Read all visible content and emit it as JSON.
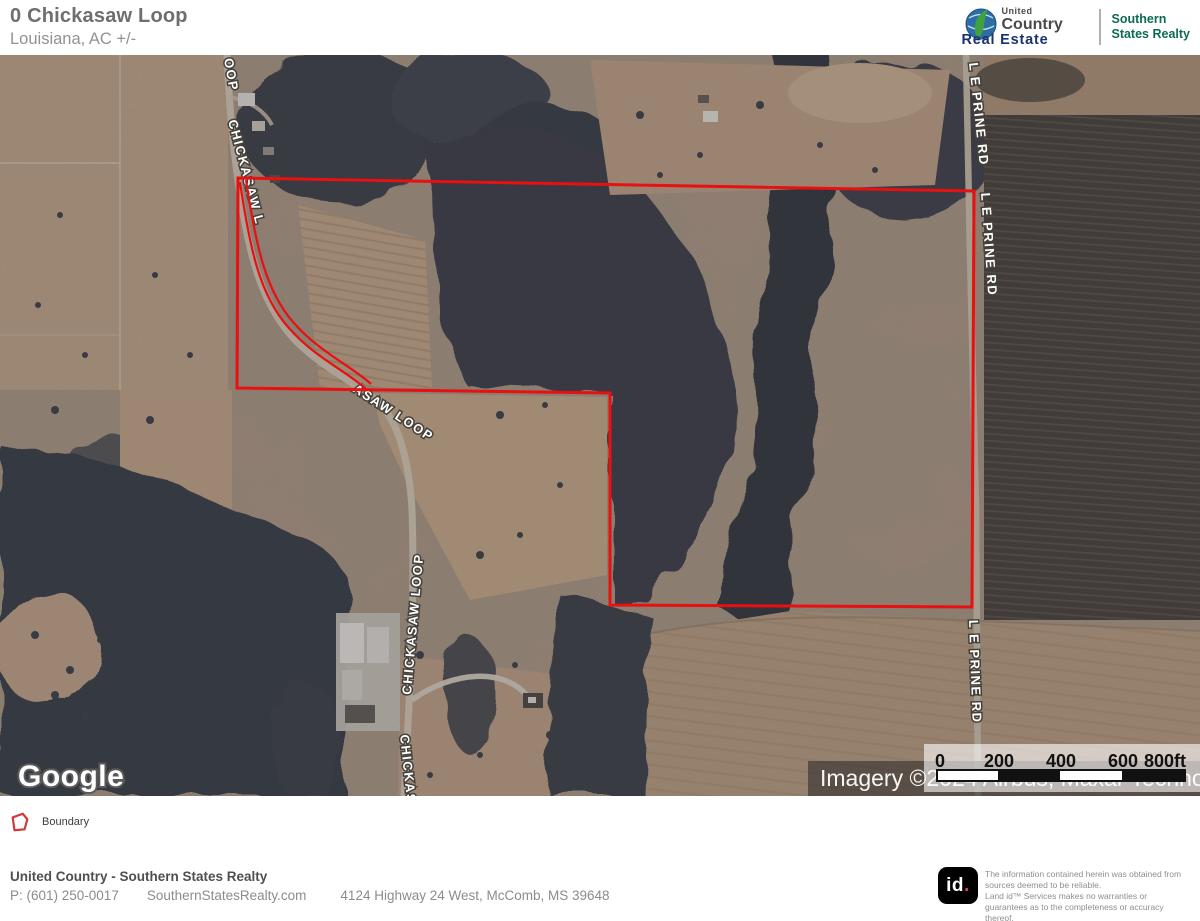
{
  "header": {
    "title": "0 Chickasaw Loop",
    "subtitle": "Louisiana,  AC +/-"
  },
  "brand": {
    "united": "United",
    "country": "Country",
    "real_estate": "Real Estate",
    "office_line1": "Southern",
    "office_line2": "States Realty"
  },
  "map": {
    "google_watermark": "Google",
    "attribution": "Imagery ©2024 Airbus, Maxar Technologies",
    "boundary_color": "#e81010",
    "road_labels": {
      "oop": "OOP",
      "chickasaw_upper": "CHICKASAW L",
      "chickasaw_mid": "ASAW LOOP",
      "chickasaw_lower": "CHICKASAW LOOP",
      "chickasaw_bottom": "CHICKASA",
      "leprine_top": "L E PRINE RD",
      "leprine_mid": "L E PRINE RD",
      "leprine_bottom": "L E PRINE RD"
    },
    "scale_bar": {
      "t0": "0",
      "t200": "200",
      "t400": "400",
      "t600": "600",
      "t800": "800ft"
    }
  },
  "legend": {
    "boundary_label": "Boundary"
  },
  "footer": {
    "company": "United Country - Southern States Realty",
    "phone": "P: (601) 250-0017",
    "website": "SouthernStatesRealty.com",
    "address": "4124 Highway 24 West, McComb, MS 39648",
    "id_logo": "id",
    "id_logo_dot": ".",
    "disclaimer_line1": "The information contained herein was obtained from sources deemed to be reliable.",
    "disclaimer_line2": "Land id™ Services makes no warranties or guarantees as to the completeness or accuracy thereof."
  }
}
